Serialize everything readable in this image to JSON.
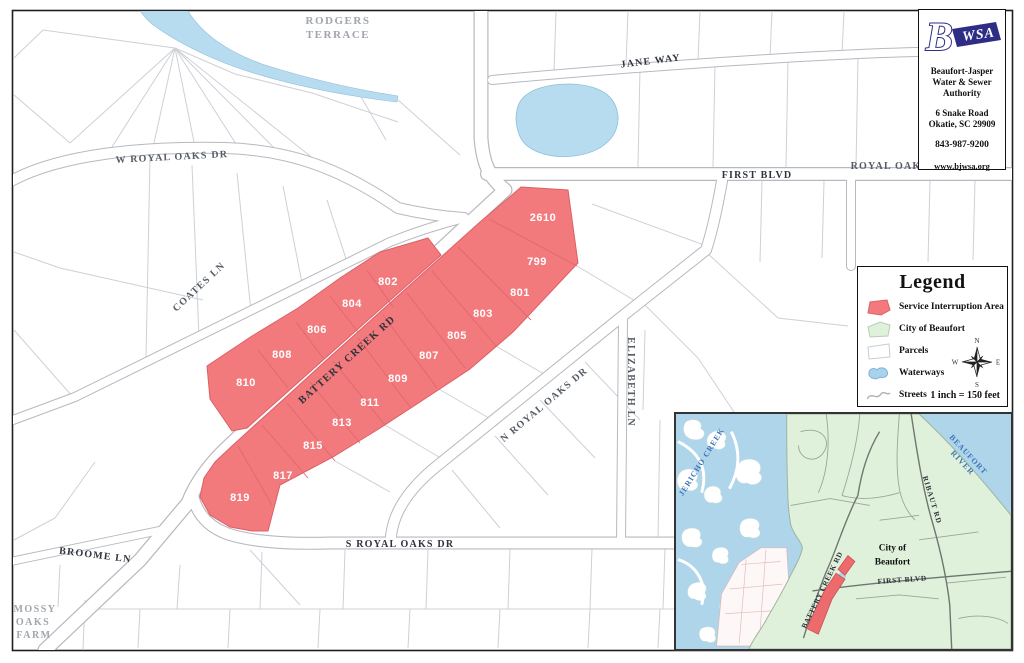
{
  "info_box": {
    "logo": {
      "b": "B",
      "wsa": "WSA"
    },
    "org": [
      "Beaufort-Jasper",
      "Water & Sewer",
      "Authority"
    ],
    "address": [
      "6 Snake Road",
      "Okatie, SC 29909"
    ],
    "phone": "843-987-9200",
    "website": "www.bjwsa.org"
  },
  "legend": {
    "title": "Legend",
    "items": [
      {
        "label": "Service Interruption Area"
      },
      {
        "label": "City of Beaufort"
      },
      {
        "label": "Parcels"
      },
      {
        "label": "Waterways"
      },
      {
        "label": "Streets"
      }
    ],
    "compass": {
      "n": "N",
      "e": "E",
      "s": "S",
      "w": "W"
    },
    "scale_text": "1 inch = 150 feet"
  },
  "map": {
    "streets": {
      "w_royal_oaks_dr": "W ROYAL OAKS DR",
      "coates_ln": "COATES LN",
      "battery_creek_rd": "BATTERY CREEK RD",
      "n_royal_oaks_dr": "N ROYAL OAKS DR",
      "s_royal_oaks_dr": "S ROYAL OAKS DR",
      "elizabeth_ln": "ELIZABETH LN",
      "broome_ln": "BROOME LN",
      "jane_way": "JANE WAY",
      "first_blvd": "FIRST BLVD",
      "royal_oak": "ROYAL OAK"
    },
    "areas": {
      "rodgers_1": "RODGERS",
      "rodgers_2": "TERRACE",
      "mossy_1": "MOSSY",
      "mossy_2": "OAKS",
      "mossy_3": "FARM"
    },
    "parcel_numbers": [
      "2610",
      "799",
      "801",
      "803",
      "805",
      "807",
      "809",
      "811",
      "813",
      "815",
      "817",
      "819",
      "802",
      "804",
      "806",
      "808",
      "810"
    ]
  },
  "inset": {
    "water_labels": {
      "jericho_creek": "JERICHO CREEK",
      "beaufort_river_1": "BEAUFORT",
      "beaufort_river_2": "RIVER"
    },
    "streets": {
      "battery_creek_rd": "BATTERY CREEK RD",
      "first_blvd": "FIRST BLVD",
      "ribaut_rd": "RIBAUT RD"
    },
    "city_label": [
      "City of",
      "Beaufort"
    ]
  },
  "colors": {
    "service_interruption_area": "#F27A7D",
    "city_of_beaufort": "#DFF0DB",
    "waterways": "#B7DCEF",
    "brand_navy": "#2E2D86"
  }
}
